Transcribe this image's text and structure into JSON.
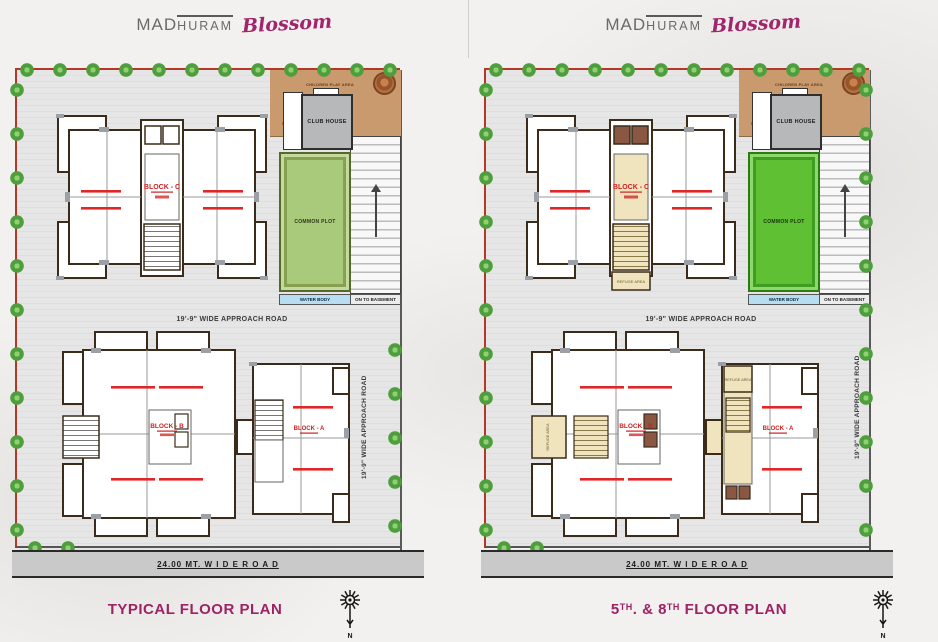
{
  "brand": {
    "mad": "MAD",
    "huram": "HURAM",
    "script": "Blossom"
  },
  "compass_label": "N",
  "colors": {
    "accent_magenta": "#9e2264",
    "boundary_red": "#b23828",
    "common_plot_green_typical": "#a9c97b",
    "common_plot_green_5th8th": "#5ec032",
    "water_blue": "#b7ddf1",
    "play_area_tan": "#c89a6e",
    "refuge_cream": "#f0e4bf",
    "lift_brown": "#8a5743",
    "flat_label_red": "#e02727",
    "tree_green": "#4f9e3d",
    "road_gray": "#c9c9c9"
  },
  "plans": [
    {
      "title": {
        "seg1": "TYPICAL FLOOR PLAN",
        "sup1": "",
        "seg2": "",
        "sup2": "",
        "seg3": ""
      },
      "labels": {
        "club_house": "CLUB HOUSE",
        "common_plot": "COMMON PLOT",
        "water_body": "WATER BODY",
        "on_to_basement": "ON TO BASEMENT",
        "children_play": "CHILDREN PLAY AREA",
        "approach_road": "19'-9\" WIDE APPROACH ROAD",
        "approach_road_v": "19'-9\" WIDE APPROACH ROAD",
        "wide_road": "24.00 MT. W I D E  R O A D",
        "block_c": "BLOCK - C",
        "block_b": "BLOCK - B",
        "block_a": "BLOCK - A"
      }
    },
    {
      "title": {
        "seg1": "5",
        "sup1": "TH",
        "seg2": ". & 8",
        "sup2": "TH",
        "seg3": " FLOOR PLAN"
      },
      "labels": {
        "club_house": "CLUB HOUSE",
        "common_plot": "COMMON PLOT",
        "water_body": "WATER BODY",
        "on_to_basement": "ON TO BASEMENT",
        "children_play": "CHILDREN PLAY AREA",
        "approach_road": "19'-9\" WIDE APPROACH ROAD",
        "approach_road_v": "19'-9\" WIDE APPROACH ROAD",
        "wide_road": "24.00 MT. W I D E  R O A D",
        "block_c": "BLOCK - C",
        "block_b": "BLOCK - B",
        "block_a": "BLOCK - A",
        "refuge_area": "REFUGE AREA"
      }
    }
  ]
}
